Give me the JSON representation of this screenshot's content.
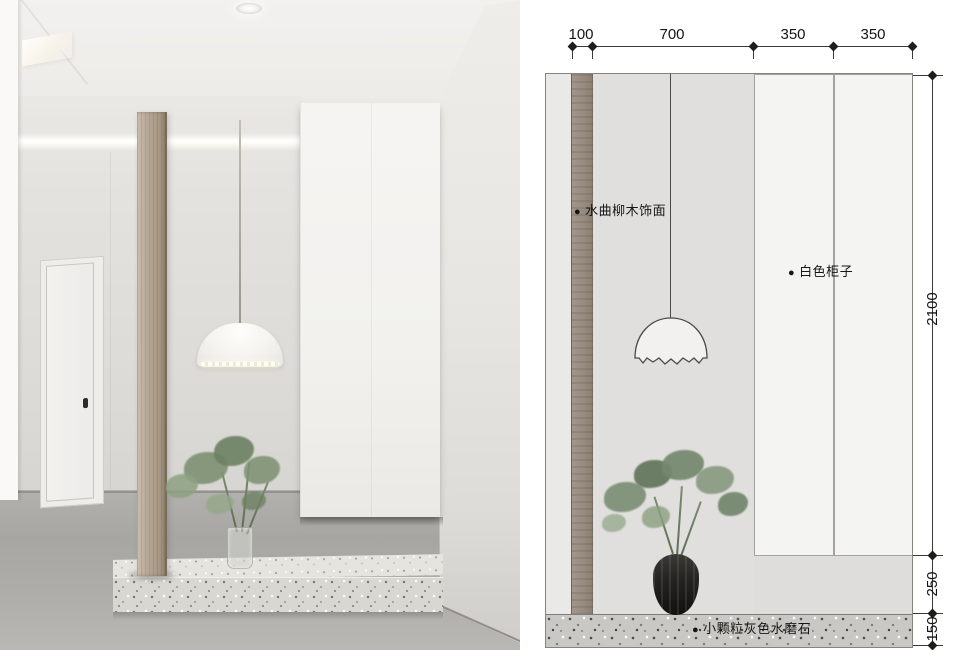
{
  "board": {
    "left_panel": "reference-photo",
    "right_panel": "elevation-drawing"
  },
  "drawing": {
    "dim_top": [
      "100",
      "700",
      "350",
      "350"
    ],
    "dim_right": [
      "2100",
      "250",
      "150"
    ],
    "callouts": [
      {
        "bullet": "●",
        "label": "水曲柳木饰面"
      },
      {
        "bullet": "●",
        "label": "白色柜子"
      },
      {
        "bullet": "●",
        "label": "小颗粒灰色水磨石"
      }
    ],
    "colors": {
      "wood_veneer": "#9b8f80",
      "wall": "#e1e0de",
      "white_cabinet": "#f4f4f2",
      "terrazzo": "#c9c8c4",
      "dimension_line": "#3a3a38",
      "foliage": "#74886d",
      "vase": "#232220"
    }
  }
}
